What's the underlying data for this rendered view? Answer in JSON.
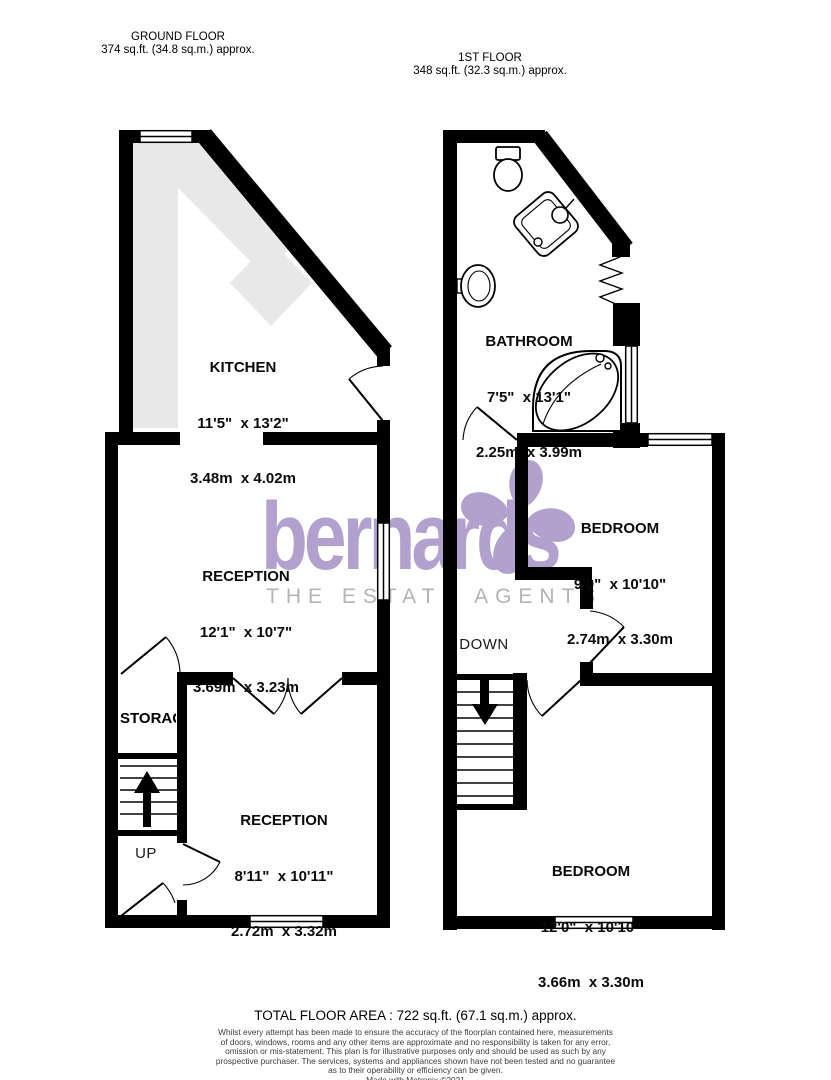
{
  "floors": {
    "ground": {
      "title": "GROUND FLOOR",
      "area": "374 sq.ft. (34.8 sq.m.) approx.",
      "rooms": {
        "kitchen": {
          "name": "KITCHEN",
          "imperial": "11'5\"  x 13'2\"",
          "metric": "3.48m  x 4.02m"
        },
        "reception1": {
          "name": "RECEPTION",
          "imperial": "12'1\"  x 10'7\"",
          "metric": "3.69m  x 3.23m"
        },
        "reception2": {
          "name": "RECEPTION",
          "imperial": "8'11\"  x 10'11\"",
          "metric": "2.72m  x 3.32m"
        },
        "storage": {
          "name": "STORAGE"
        }
      },
      "stairs_label": "UP"
    },
    "first": {
      "title": "1ST FLOOR",
      "area": "348 sq.ft. (32.3 sq.m.) approx.",
      "rooms": {
        "bathroom": {
          "name": "BATHROOM",
          "imperial": "7'5\"  x 13'1\"",
          "metric": "2.25m  x 3.99m"
        },
        "bedroom1": {
          "name": "BEDROOM",
          "imperial": "9'0\"  x 10'10\"",
          "metric": "2.74m  x 3.30m"
        },
        "bedroom2": {
          "name": "BEDROOM",
          "imperial": "12'0\"  x 10'10\"",
          "metric": "3.66m  x 3.30m"
        }
      },
      "stairs_label": "DOWN"
    }
  },
  "watermark": {
    "brand": "bernards",
    "tagline": "THE ESTATE AGENTS",
    "brand_color": "#b2a0ce",
    "tagline_color": "#b4b4b4"
  },
  "footer": {
    "total_area": "TOTAL FLOOR AREA : 722 sq.ft. (67.1 sq.m.) approx.",
    "disclaimer_lines": [
      "Whilst every attempt has been made to ensure the accuracy of the floorplan contained here, measurements",
      "of doors, windows, rooms and any other items are approximate and no responsibility is taken for any error,",
      "omission or mis-statement. This plan is for illustrative purposes only and should be used as such by any",
      "prospective purchaser. The services, systems and appliances shown have not been tested and no guarantee",
      "as to their operability or efficiency can be given."
    ],
    "credit": "Made with Metropix ©2021"
  },
  "colors": {
    "wall": "#000000",
    "kitchen_counter": "#e8e8e8"
  }
}
